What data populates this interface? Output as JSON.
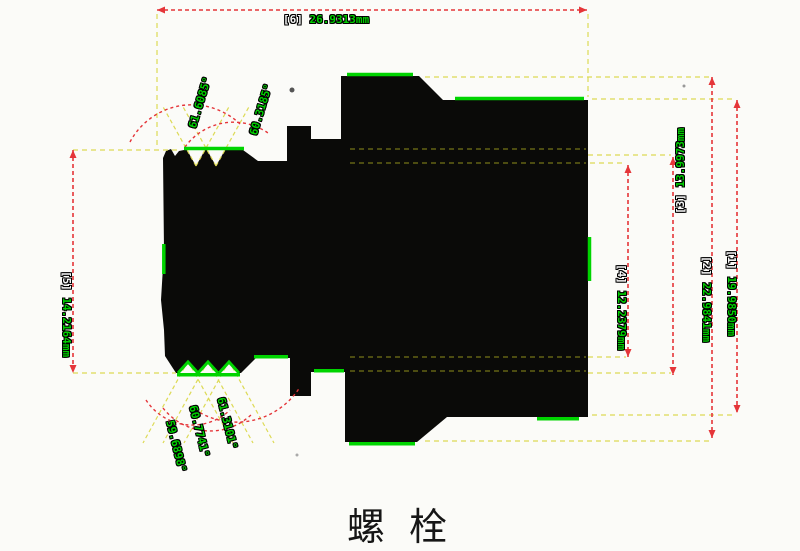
{
  "title": "螺 栓",
  "colors": {
    "background": "#fbfbf8",
    "silhouette": "#0a0a08",
    "edge_highlight": "#00d400",
    "dimension_line": "#e53539",
    "extension_line": "#ddda55",
    "label_value": "#00cf00",
    "label_ref": "#f4f4f4",
    "title_text": "#161616"
  },
  "measurements": [
    {
      "ref": "[6]",
      "value": "26.9313mm"
    },
    {
      "ref": "[5]",
      "value": "14.2164mm"
    },
    {
      "ref": "[4]",
      "value": "12.2379mm"
    },
    {
      "ref": "[3]",
      "value": "13.9973mm"
    },
    {
      "ref": "[2]",
      "value": "22.9841mm"
    },
    {
      "ref": "[1]",
      "value": "19.9850mm"
    }
  ],
  "angles": {
    "top": [
      "61.6085°",
      "60.3185°"
    ],
    "bottom": [
      "59.6898°",
      "60.7741°",
      "61.3101°"
    ]
  }
}
